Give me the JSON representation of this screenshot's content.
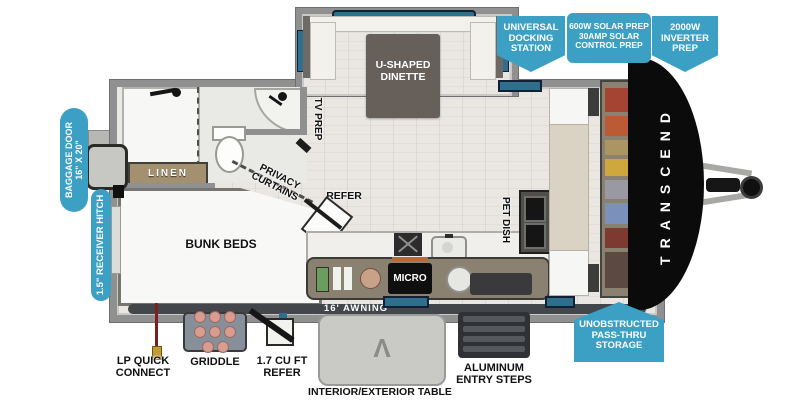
{
  "brand": {
    "front_cap_text": "TRANSCEND"
  },
  "callouts": {
    "docking_station": [
      "UNIVERSAL",
      "DOCKING",
      "STATION"
    ],
    "solar_prep": [
      "600W SOLAR PREP",
      "30AMP SOLAR",
      "CONTROL PREP"
    ],
    "inverter_prep": [
      "2000W",
      "INVERTER",
      "PREP"
    ],
    "baggage_door": [
      "BAGGAGE DOOR",
      "16\" X 20\""
    ],
    "receiver_hitch": "1.5\" RECEIVER HITCH",
    "pass_thru_storage": [
      "UNOBSTRUCTED",
      "PASS-THRU",
      "STORAGE"
    ]
  },
  "floorplan_labels": {
    "dinette": [
      "U-SHAPED",
      "DINETTE"
    ],
    "tv_prep": "TV PREP",
    "linen": "LINEN",
    "privacy_curtains": [
      "PRIVACY",
      "CURTAINS"
    ],
    "bunk_beds": "BUNK BEDS",
    "refer": "REFER",
    "pet_dish": "PET DISH",
    "micro": "MICRO",
    "awning": "16' AWNING"
  },
  "exterior_features": {
    "lp_quick_connect": [
      "LP QUICK",
      "CONNECT"
    ],
    "griddle": "GRIDDLE",
    "compact_refer": [
      "1.7 CU FT",
      "REFER"
    ],
    "table": "INTERIOR/EXTERIOR TABLE",
    "entry_steps": [
      "ALUMINUM",
      "ENTRY STEPS"
    ],
    "table_logo_glyph": "Λ"
  },
  "colors": {
    "callout_blue": "#3BA0C4",
    "wall_gray": "#909090",
    "front_cap_black": "#0B0B0B",
    "window_teal": "#2E6F8E",
    "floor": "#EAE7E2",
    "wardrobe_clothes": [
      "#A64434",
      "#BD5A36",
      "#AD9463",
      "#CFA83D",
      "#999AA1",
      "#7B90BA",
      "#7D3A31",
      "#5C4A42"
    ]
  },
  "icons": {
    "griddle_icon": "griddle with 8 patties",
    "entry_steps_icon": "triple fold-out steps",
    "lp_hose_icon": "red lp gas hose",
    "mini_refer_icon": "open compact refrigerator",
    "tongue_jack_icon": "a-frame hitch with jack wheel",
    "shower_icon": "shower fixture",
    "toilet_icon": "toilet",
    "sink_icon": "corner sink",
    "stove_icon": "cooktop",
    "kitchen_sink_icon": "round kitchen sink"
  }
}
